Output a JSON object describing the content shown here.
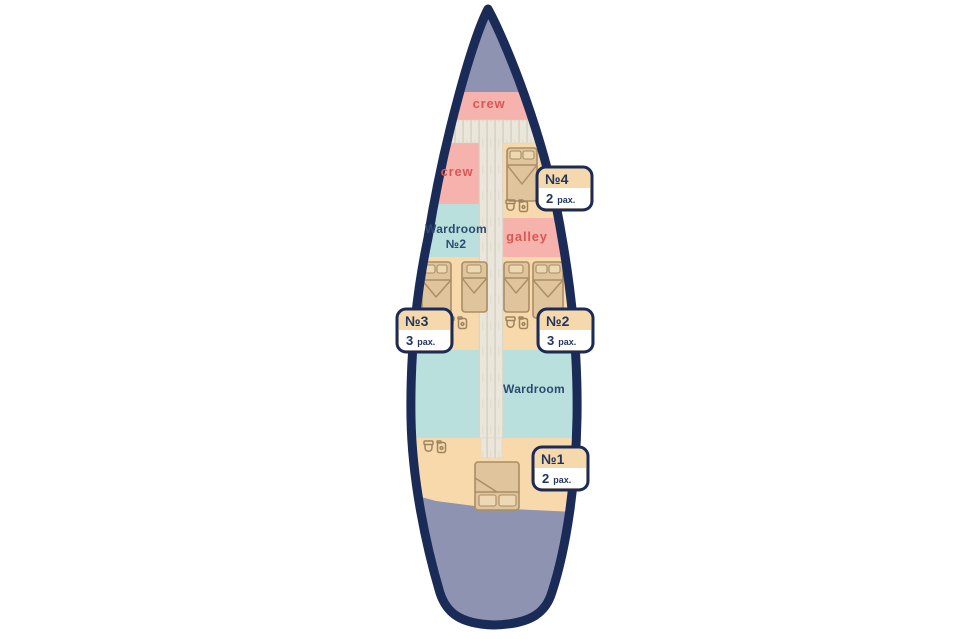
{
  "diagram": {
    "type": "yacht-deck-plan",
    "description": "Top-down interior deck plan of a sailing yacht"
  },
  "colors": {
    "page_background": "#ffffff",
    "hull_outline": "#1b2b57",
    "deck_gray": "#8e93b2",
    "crew_pink": "#f6b3ae",
    "cabin_tan": "#f8d9ac",
    "lounge_teal": "#bae0de",
    "corridor": "#eae6db",
    "corridor_stripe": "#d8d3c3",
    "bed_fill": "#dfc49c",
    "bed_outline": "#a98e64",
    "pillow_fill": "#ecd9b4",
    "label_red": "#d95752",
    "label_navy": "#2c4a70",
    "badge_border": "#1b2b57",
    "badge_top": "#f6d8ad",
    "badge_bottom": "#ffffff"
  },
  "rooms": {
    "crew_bow": "crew",
    "crew_port": "crew",
    "galley": "galley",
    "wardroom2_line1": "Wardroom",
    "wardroom2_line2": "№2",
    "wardroom_main": "Wardroom"
  },
  "cabins": [
    {
      "id": "№4",
      "pax": "2",
      "pax_unit": "pax."
    },
    {
      "id": "№3",
      "pax": "3",
      "pax_unit": "pax."
    },
    {
      "id": "№2",
      "pax": "3",
      "pax_unit": "pax."
    },
    {
      "id": "№1",
      "pax": "2",
      "pax_unit": "pax."
    }
  ],
  "icons": [
    "double-bed-icon",
    "single-bed-icon",
    "toilet-icon",
    "sink-icon"
  ]
}
